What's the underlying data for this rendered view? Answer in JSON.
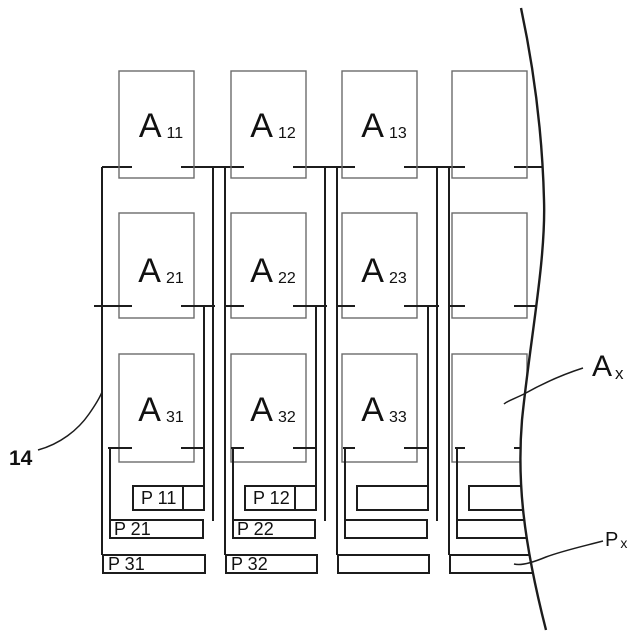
{
  "figure": {
    "kind": "patent-style block diagram, 4-column grid of driver blocks with pad terminals, right side cut by a break line",
    "annotations": {
      "ref_number": "14",
      "block_generic": {
        "base": "A",
        "sub": "x"
      },
      "pad_generic": {
        "base": "P",
        "sub": "x"
      }
    },
    "columns": [
      {
        "blocks": [
          {
            "base": "A",
            "sub": "11"
          },
          {
            "base": "A",
            "sub": "21"
          },
          {
            "base": "A",
            "sub": "31"
          }
        ],
        "pads": [
          "P 11",
          "P 21",
          "P 31"
        ],
        "pad1_divider": true
      },
      {
        "blocks": [
          {
            "base": "A",
            "sub": "12"
          },
          {
            "base": "A",
            "sub": "22"
          },
          {
            "base": "A",
            "sub": "32"
          }
        ],
        "pads": [
          "P 12",
          "P 22",
          "P 32"
        ],
        "pad1_divider": true
      },
      {
        "blocks": [
          {
            "base": "A",
            "sub": "13"
          },
          {
            "base": "A",
            "sub": "23"
          },
          {
            "base": "A",
            "sub": "33"
          }
        ],
        "pads": [
          "",
          "",
          ""
        ],
        "pad1_divider": false
      },
      {
        "blocks": [
          null,
          null,
          null
        ],
        "pads": [
          "",
          "",
          ""
        ],
        "pad1_divider": false
      }
    ],
    "colors": {
      "background": "#ffffff",
      "structure_line": "#1c1c1c",
      "block_outline": "#6b6b6b",
      "text": "#111111"
    }
  }
}
